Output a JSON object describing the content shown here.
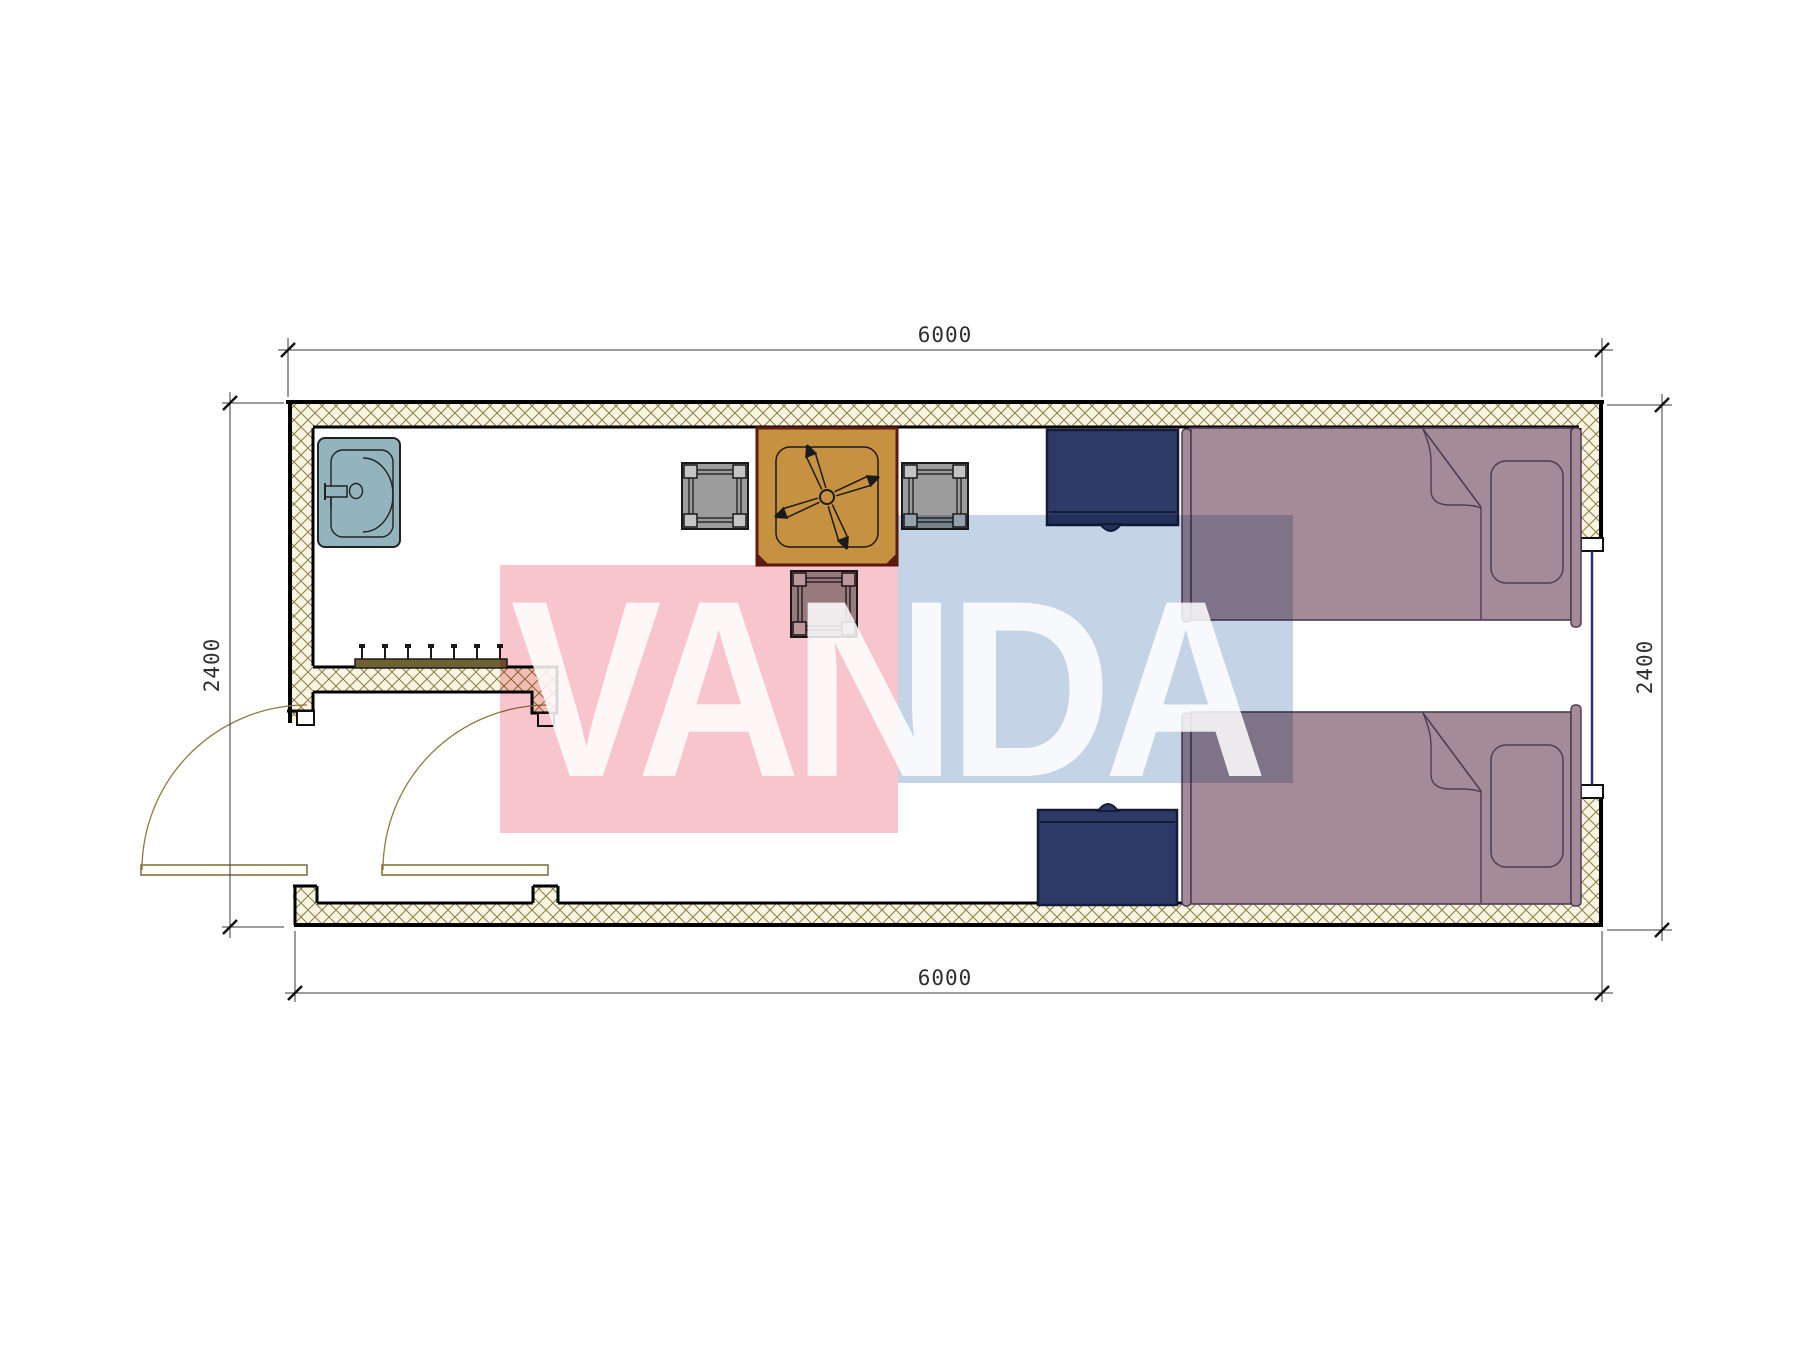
{
  "drawing": {
    "type": "architectural-floor-plan",
    "unit": "mm",
    "dimensions": {
      "top": "6000",
      "bottom": "6000",
      "left": "2400",
      "right": "2400"
    },
    "watermark": {
      "text": "VANDA",
      "pink_color": "#f8c5cd",
      "blue_color": "#c5d3e6",
      "text_color": "rgba(255,255,255,0.85)"
    },
    "colors": {
      "wall_fill": "#faf5e2",
      "wall_hatch_line": "#8d7c42",
      "wall_outline": "#000000",
      "sink": "#93b4bd",
      "table": "#c69140",
      "table_border": "#5e1b10",
      "chair": "#9c9c9c",
      "nightstand": "#2d3a66",
      "bed": "#a48b97",
      "bed_outline": "#4d3d57",
      "door_swing": "#8d7c42",
      "window_glazing": "#28306e",
      "dimension_lines": "#3a3a3a"
    },
    "elements": [
      "exterior-walls",
      "interior-partition-wall",
      "coat-hook-rail",
      "wash-basin",
      "square-table-with-ceiling-fan",
      "chair-left",
      "chair-right",
      "chair-bottom",
      "nightstand-top",
      "nightstand-bottom",
      "single-bed-top",
      "single-bed-bottom",
      "entry-door-left-wall",
      "vestibule-door",
      "window-right-wall"
    ]
  }
}
